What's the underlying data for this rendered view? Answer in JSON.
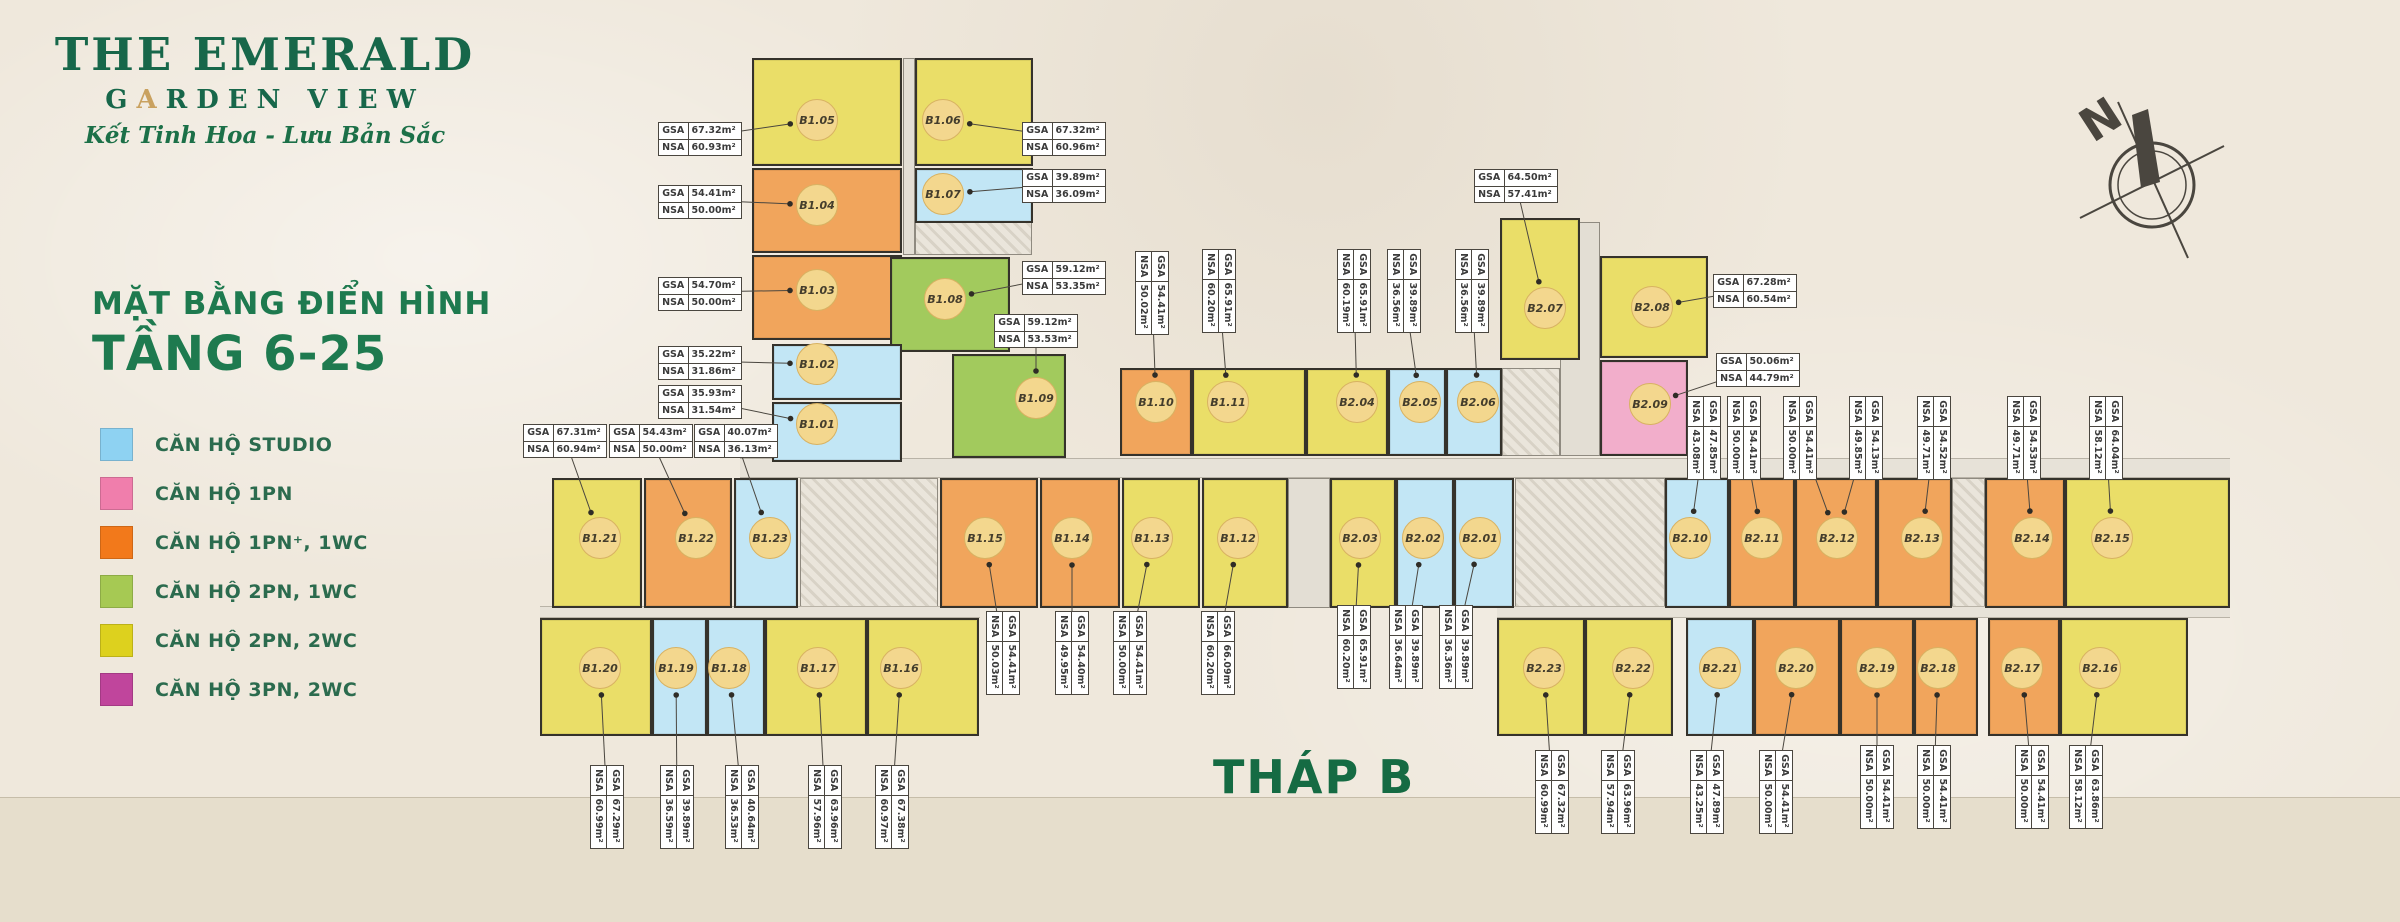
{
  "branding": {
    "title": "THE EMERALD",
    "garden_g": "G",
    "garden_a": "A",
    "garden_rest": "RDEN VIEW",
    "tagline": "Kết Tinh Hoa - Lưu Bản Sắc"
  },
  "plan_header": {
    "line1": "MẶT BẰNG  ĐIỂN HÌNH",
    "line2": "TẦNG 6-25"
  },
  "tower_label": "THÁP B",
  "compass_label": "N",
  "area_labels": {
    "gsa": "GSA",
    "nsa": "NSA"
  },
  "colors": {
    "legend": {
      "studio": "#8ED2F2",
      "1pn": "#F07EAC",
      "1pnp": "#F2791B",
      "2pn1wc": "#A6C953",
      "2pn2wc": "#DDD11E",
      "3pn2wc": "#C0459C"
    },
    "unit": {
      "studio": "#C2E6F5",
      "1pn": "#F2AECB",
      "1pnp": "#F1A55C",
      "2pn1wc": "#A2CA5D",
      "2pn2wc": "#EADE68",
      "3pn2wc": "#CE6FB0"
    },
    "accent_green": "#17674A",
    "gold": "#C9A15F"
  },
  "legend": [
    {
      "key": "studio",
      "label": "CĂN HỘ STUDIO"
    },
    {
      "key": "1pn",
      "label": "CĂN HỘ 1PN"
    },
    {
      "key": "1pnp",
      "label": "CĂN HỘ 1PN⁺, 1WC"
    },
    {
      "key": "2pn1wc",
      "label": "CĂN HỘ 2PN, 1WC"
    },
    {
      "key": "2pn2wc",
      "label": "CĂN HỘ 2PN, 2WC"
    },
    {
      "key": "3pn2wc",
      "label": "CĂN HỘ 3PN, 2WC"
    }
  ],
  "units": [
    {
      "id": "B1.05",
      "type": "2pn2wc",
      "x": 752,
      "y": 58,
      "w": 150,
      "h": 108,
      "cx": 817,
      "cy": 120,
      "gsa": "67.32m²",
      "nsa": "60.93m²"
    },
    {
      "id": "B1.06",
      "type": "2pn2wc",
      "x": 915,
      "y": 58,
      "w": 118,
      "h": 108,
      "cx": 943,
      "cy": 120,
      "gsa": "67.32m²",
      "nsa": "60.96m²"
    },
    {
      "id": "B1.04",
      "type": "1pnp",
      "x": 752,
      "y": 168,
      "w": 150,
      "h": 85,
      "cx": 817,
      "cy": 205,
      "gsa": "54.41m²",
      "nsa": "50.00m²"
    },
    {
      "id": "B1.07",
      "type": "studio",
      "x": 915,
      "y": 168,
      "w": 118,
      "h": 55,
      "cx": 943,
      "cy": 194,
      "gsa": "39.89m²",
      "nsa": "36.09m²"
    },
    {
      "id": "B1.03",
      "type": "1pnp",
      "x": 752,
      "y": 255,
      "w": 150,
      "h": 85,
      "cx": 817,
      "cy": 290,
      "gsa": "54.70m²",
      "nsa": "50.00m²"
    },
    {
      "id": "B1.08",
      "type": "2pn1wc",
      "x": 890,
      "y": 257,
      "w": 120,
      "h": 95,
      "cx": 945,
      "cy": 299,
      "gsa": "59.12m²",
      "nsa": "53.35m²"
    },
    {
      "id": "B1.02",
      "type": "studio",
      "x": 772,
      "y": 344,
      "w": 130,
      "h": 56,
      "cx": 817,
      "cy": 364,
      "gsa": "35.22m²",
      "nsa": "31.86m²"
    },
    {
      "id": "B1.01",
      "type": "studio",
      "x": 772,
      "y": 402,
      "w": 130,
      "h": 60,
      "cx": 817,
      "cy": 424,
      "gsa": "35.93m²",
      "nsa": "31.54m²"
    },
    {
      "id": "B1.09",
      "type": "2pn1wc",
      "x": 952,
      "y": 354,
      "w": 114,
      "h": 104,
      "cx": 1036,
      "cy": 398,
      "gsa": "59.12m²",
      "nsa": "53.53m²"
    },
    {
      "id": "B1.10",
      "type": "1pnp",
      "x": 1120,
      "y": 368,
      "w": 72,
      "h": 88,
      "cx": 1156,
      "cy": 402,
      "gsa": "54.41m²",
      "nsa": "50.02m²"
    },
    {
      "id": "B1.11",
      "type": "2pn2wc",
      "x": 1192,
      "y": 368,
      "w": 114,
      "h": 88,
      "cx": 1228,
      "cy": 402,
      "gsa": "65.91m²",
      "nsa": "60.20m²"
    },
    {
      "id": "B2.04",
      "type": "2pn2wc",
      "x": 1306,
      "y": 368,
      "w": 82,
      "h": 88,
      "cx": 1357,
      "cy": 402,
      "gsa": "65.91m²",
      "nsa": "60.19m²"
    },
    {
      "id": "B2.05",
      "type": "studio",
      "x": 1388,
      "y": 368,
      "w": 58,
      "h": 88,
      "cx": 1420,
      "cy": 402,
      "gsa": "39.89m²",
      "nsa": "36.56m²"
    },
    {
      "id": "B2.06",
      "type": "studio",
      "x": 1446,
      "y": 368,
      "w": 56,
      "h": 88,
      "cx": 1478,
      "cy": 402,
      "gsa": "39.89m²",
      "nsa": "36.56m²"
    },
    {
      "id": "B2.07",
      "type": "2pn2wc",
      "x": 1500,
      "y": 218,
      "w": 80,
      "h": 142,
      "cx": 1545,
      "cy": 308,
      "gsa": "64.50m²",
      "nsa": "57.41m²"
    },
    {
      "id": "B2.08",
      "type": "2pn2wc",
      "x": 1600,
      "y": 256,
      "w": 108,
      "h": 102,
      "cx": 1652,
      "cy": 307,
      "gsa": "67.28m²",
      "nsa": "60.54m²"
    },
    {
      "id": "B2.09",
      "type": "1pn",
      "x": 1600,
      "y": 360,
      "w": 88,
      "h": 96,
      "cx": 1650,
      "cy": 404,
      "gsa": "50.06m²",
      "nsa": "44.79m²"
    },
    {
      "id": "B1.21",
      "type": "2pn2wc",
      "x": 552,
      "y": 478,
      "w": 90,
      "h": 130,
      "cx": 600,
      "cy": 538,
      "gsa": "67.31m²",
      "nsa": "60.94m²"
    },
    {
      "id": "B1.22",
      "type": "1pnp",
      "x": 644,
      "y": 478,
      "w": 88,
      "h": 130,
      "cx": 696,
      "cy": 538,
      "gsa": "54.43m²",
      "nsa": "50.00m²"
    },
    {
      "id": "B1.23",
      "type": "studio",
      "x": 734,
      "y": 478,
      "w": 64,
      "h": 130,
      "cx": 770,
      "cy": 538,
      "gsa": "40.07m²",
      "nsa": "36.13m²"
    },
    {
      "id": "B1.15",
      "type": "1pnp",
      "x": 940,
      "y": 478,
      "w": 98,
      "h": 130,
      "cx": 985,
      "cy": 538,
      "gsa": "54.41m²",
      "nsa": "50.03m²"
    },
    {
      "id": "B1.14",
      "type": "1pnp",
      "x": 1040,
      "y": 478,
      "w": 80,
      "h": 130,
      "cx": 1072,
      "cy": 538,
      "gsa": "54.40m²",
      "nsa": "49.95m²"
    },
    {
      "id": "B1.13",
      "type": "2pn2wc",
      "x": 1122,
      "y": 478,
      "w": 78,
      "h": 130,
      "cx": 1152,
      "cy": 538,
      "gsa": "54.41m²",
      "nsa": "50.00m²"
    },
    {
      "id": "B1.12",
      "type": "2pn2wc",
      "x": 1202,
      "y": 478,
      "w": 86,
      "h": 130,
      "cx": 1238,
      "cy": 538,
      "gsa": "66.09m²",
      "nsa": "60.20m²"
    },
    {
      "id": "B2.03",
      "type": "2pn2wc",
      "x": 1330,
      "y": 478,
      "w": 66,
      "h": 130,
      "cx": 1360,
      "cy": 538,
      "gsa": "65.91m²",
      "nsa": "60.20m²"
    },
    {
      "id": "B2.02",
      "type": "studio",
      "x": 1396,
      "y": 478,
      "w": 58,
      "h": 130,
      "cx": 1423,
      "cy": 538,
      "gsa": "39.89m²",
      "nsa": "36.64m²"
    },
    {
      "id": "B2.01",
      "type": "studio",
      "x": 1454,
      "y": 478,
      "w": 60,
      "h": 130,
      "cx": 1480,
      "cy": 538,
      "gsa": "39.89m²",
      "nsa": "36.36m²"
    },
    {
      "id": "B2.10",
      "type": "studio",
      "x": 1665,
      "y": 478,
      "w": 64,
      "h": 130,
      "cx": 1690,
      "cy": 538,
      "gsa": "47.85m²",
      "nsa": "43.08m²"
    },
    {
      "id": "B2.11",
      "type": "1pnp",
      "x": 1729,
      "y": 478,
      "w": 66,
      "h": 130,
      "cx": 1762,
      "cy": 538,
      "gsa": "54.41m²",
      "nsa": "50.00m²"
    },
    {
      "id": "B2.12",
      "type": "1pnp",
      "x": 1795,
      "y": 478,
      "w": 82,
      "h": 130,
      "cx": 1837,
      "cy": 538,
      "gsa": "54.41m²",
      "nsa": "50.00m²"
    },
    {
      "id": "B2.13",
      "type": "1pnp",
      "x": 1877,
      "y": 478,
      "w": 75,
      "h": 130,
      "cx": 1922,
      "cy": 538,
      "gsa": "54.52m²",
      "nsa": "49.71m²"
    },
    {
      "id": "B2.14",
      "type": "1pnp",
      "x": 1985,
      "y": 478,
      "w": 80,
      "h": 130,
      "cx": 2032,
      "cy": 538,
      "gsa": "54.53m²",
      "nsa": "49.71m²"
    },
    {
      "id": "B2.15",
      "type": "2pn2wc",
      "x": 2065,
      "y": 478,
      "w": 165,
      "h": 130,
      "cx": 2112,
      "cy": 538,
      "gsa": "64.04m²",
      "nsa": "58.12m²"
    },
    {
      "id": "B1.20",
      "type": "2pn2wc",
      "x": 540,
      "y": 618,
      "w": 112,
      "h": 118,
      "cx": 600,
      "cy": 668,
      "gsa": "67.29m²",
      "nsa": "60.99m²"
    },
    {
      "id": "B1.19",
      "type": "studio",
      "x": 652,
      "y": 618,
      "w": 55,
      "h": 118,
      "cx": 676,
      "cy": 668,
      "gsa": "39.89m²",
      "nsa": "36.59m²"
    },
    {
      "id": "B1.18",
      "type": "studio",
      "x": 707,
      "y": 618,
      "w": 58,
      "h": 118,
      "cx": 729,
      "cy": 668,
      "gsa": "40.64m²",
      "nsa": "36.53m²"
    },
    {
      "id": "B1.17",
      "type": "2pn2wc",
      "x": 765,
      "y": 618,
      "w": 102,
      "h": 118,
      "cx": 818,
      "cy": 668,
      "gsa": "63.96m²",
      "nsa": "57.96m²"
    },
    {
      "id": "B1.16",
      "type": "2pn2wc",
      "x": 867,
      "y": 618,
      "w": 112,
      "h": 118,
      "cx": 901,
      "cy": 668,
      "gsa": "67.38m²",
      "nsa": "60.97m²"
    },
    {
      "id": "B2.23",
      "type": "2pn2wc",
      "x": 1497,
      "y": 618,
      "w": 88,
      "h": 118,
      "cx": 1544,
      "cy": 668,
      "gsa": "67.32m²",
      "nsa": "60.99m²"
    },
    {
      "id": "B2.22",
      "type": "2pn2wc",
      "x": 1585,
      "y": 618,
      "w": 88,
      "h": 118,
      "cx": 1633,
      "cy": 668,
      "gsa": "63.96m²",
      "nsa": "57.94m²"
    },
    {
      "id": "B2.21",
      "type": "studio",
      "x": 1686,
      "y": 618,
      "w": 68,
      "h": 118,
      "cx": 1720,
      "cy": 668,
      "gsa": "47.89m²",
      "nsa": "43.25m²"
    },
    {
      "id": "B2.20",
      "type": "1pnp",
      "x": 1754,
      "y": 618,
      "w": 86,
      "h": 118,
      "cx": 1796,
      "cy": 668,
      "gsa": "54.41m²",
      "nsa": "50.00m²"
    },
    {
      "id": "B2.19",
      "type": "1pnp",
      "x": 1840,
      "y": 618,
      "w": 74,
      "h": 118,
      "cx": 1877,
      "cy": 668,
      "gsa": "54.41m²",
      "nsa": "50.00m²"
    },
    {
      "id": "B2.18",
      "type": "1pnp",
      "x": 1914,
      "y": 618,
      "w": 64,
      "h": 118,
      "cx": 1938,
      "cy": 668,
      "gsa": "54.41m²",
      "nsa": "50.00m²"
    },
    {
      "id": "B2.17",
      "type": "1pnp",
      "x": 1988,
      "y": 618,
      "w": 72,
      "h": 118,
      "cx": 2022,
      "cy": 668,
      "gsa": "54.41m²",
      "nsa": "50.00m²"
    },
    {
      "id": "B2.16",
      "type": "2pn2wc",
      "x": 2060,
      "y": 618,
      "w": 128,
      "h": 118,
      "cx": 2100,
      "cy": 668,
      "gsa": "63.86m²",
      "nsa": "58.12m²"
    }
  ],
  "tables": [
    {
      "u": "B1.05",
      "cx": 700,
      "cy": 137,
      "v": false
    },
    {
      "u": "B1.06",
      "cx": 1064,
      "cy": 137,
      "v": false
    },
    {
      "u": "B1.07",
      "cx": 1064,
      "cy": 184,
      "v": false
    },
    {
      "u": "B1.04",
      "cx": 700,
      "cy": 200,
      "v": false
    },
    {
      "u": "B1.03",
      "cx": 700,
      "cy": 292,
      "v": false
    },
    {
      "u": "B1.08",
      "cx": 1064,
      "cy": 276,
      "v": false
    },
    {
      "u": "B1.09",
      "cx": 1036,
      "cy": 329,
      "v": false
    },
    {
      "u": "B1.02",
      "cx": 700,
      "cy": 361,
      "v": false
    },
    {
      "u": "B1.01",
      "cx": 700,
      "cy": 400,
      "v": false
    },
    {
      "u": "B1.21",
      "cx": 565,
      "cy": 439,
      "v": false
    },
    {
      "u": "B1.22",
      "cx": 651,
      "cy": 439,
      "v": false
    },
    {
      "u": "B1.23",
      "cx": 736,
      "cy": 439,
      "v": false
    },
    {
      "u": "B2.07",
      "cx": 1516,
      "cy": 184,
      "v": false
    },
    {
      "u": "B2.08",
      "cx": 1755,
      "cy": 289,
      "v": false
    },
    {
      "u": "B2.09",
      "cx": 1758,
      "cy": 368,
      "v": false
    },
    {
      "u": "B1.10",
      "cx": 1152,
      "cy": 291,
      "v": true
    },
    {
      "u": "B1.11",
      "cx": 1219,
      "cy": 289,
      "v": true
    },
    {
      "u": "B2.04",
      "cx": 1354,
      "cy": 289,
      "v": true
    },
    {
      "u": "B2.05",
      "cx": 1404,
      "cy": 289,
      "v": true
    },
    {
      "u": "B2.06",
      "cx": 1472,
      "cy": 289,
      "v": true
    },
    {
      "u": "B2.10",
      "cx": 1704,
      "cy": 436,
      "v": true
    },
    {
      "u": "B2.11",
      "cx": 1744,
      "cy": 436,
      "v": true
    },
    {
      "u": "B2.12",
      "cx": 1800,
      "cy": 436,
      "v": true
    },
    {
      "u": "B2.12",
      "cx": 1866,
      "cy": 436,
      "v": true,
      "gsa": "54.13m²",
      "nsa": "49.85m²"
    },
    {
      "u": "B2.13",
      "cx": 1934,
      "cy": 436,
      "v": true
    },
    {
      "u": "B2.14",
      "cx": 2024,
      "cy": 436,
      "v": true
    },
    {
      "u": "B2.15",
      "cx": 2106,
      "cy": 436,
      "v": true
    },
    {
      "u": "B1.15",
      "cx": 1003,
      "cy": 651,
      "v": true
    },
    {
      "u": "B1.14",
      "cx": 1072,
      "cy": 651,
      "v": true
    },
    {
      "u": "B1.13",
      "cx": 1130,
      "cy": 651,
      "v": true
    },
    {
      "u": "B1.12",
      "cx": 1218,
      "cy": 651,
      "v": true
    },
    {
      "u": "B2.03",
      "cx": 1354,
      "cy": 645,
      "v": true
    },
    {
      "u": "B2.02",
      "cx": 1406,
      "cy": 645,
      "v": true
    },
    {
      "u": "B2.01",
      "cx": 1456,
      "cy": 645,
      "v": true
    },
    {
      "u": "B1.20",
      "cx": 607,
      "cy": 805,
      "v": true
    },
    {
      "u": "B1.19",
      "cx": 677,
      "cy": 805,
      "v": true
    },
    {
      "u": "B1.18",
      "cx": 742,
      "cy": 805,
      "v": true
    },
    {
      "u": "B1.17",
      "cx": 825,
      "cy": 805,
      "v": true
    },
    {
      "u": "B1.16",
      "cx": 892,
      "cy": 805,
      "v": true
    },
    {
      "u": "B2.23",
      "cx": 1552,
      "cy": 790,
      "v": true
    },
    {
      "u": "B2.22",
      "cx": 1618,
      "cy": 790,
      "v": true
    },
    {
      "u": "B2.21",
      "cx": 1707,
      "cy": 790,
      "v": true
    },
    {
      "u": "B2.20",
      "cx": 1776,
      "cy": 790,
      "v": true
    },
    {
      "u": "B2.19",
      "cx": 1877,
      "cy": 785,
      "v": true
    },
    {
      "u": "B2.18",
      "cx": 1934,
      "cy": 785,
      "v": true
    },
    {
      "u": "B2.17",
      "cx": 2032,
      "cy": 785,
      "v": true
    },
    {
      "u": "B2.16",
      "cx": 2086,
      "cy": 785,
      "v": true
    }
  ],
  "cores": [
    {
      "x": 903,
      "y": 58,
      "w": 12,
      "h": 197,
      "kind": "plain"
    },
    {
      "x": 915,
      "y": 222,
      "w": 117,
      "h": 33,
      "kind": "hatch"
    },
    {
      "x": 800,
      "y": 478,
      "w": 138,
      "h": 132,
      "kind": "hatch"
    },
    {
      "x": 1288,
      "y": 478,
      "w": 42,
      "h": 130,
      "kind": "plain"
    },
    {
      "x": 1515,
      "y": 478,
      "w": 150,
      "h": 130,
      "kind": "hatch"
    },
    {
      "x": 1952,
      "y": 478,
      "w": 33,
      "h": 130,
      "kind": "hatch"
    },
    {
      "x": 1502,
      "y": 368,
      "w": 58,
      "h": 88,
      "kind": "hatch"
    },
    {
      "x": 1560,
      "y": 222,
      "w": 40,
      "h": 234,
      "kind": "plain"
    },
    {
      "x": 740,
      "y": 458,
      "w": 1490,
      "h": 20,
      "kind": "corridor"
    },
    {
      "x": 540,
      "y": 606,
      "w": 440,
      "h": 12,
      "kind": "corridor"
    },
    {
      "x": 1497,
      "y": 606,
      "w": 733,
      "h": 12,
      "kind": "corridor"
    }
  ]
}
